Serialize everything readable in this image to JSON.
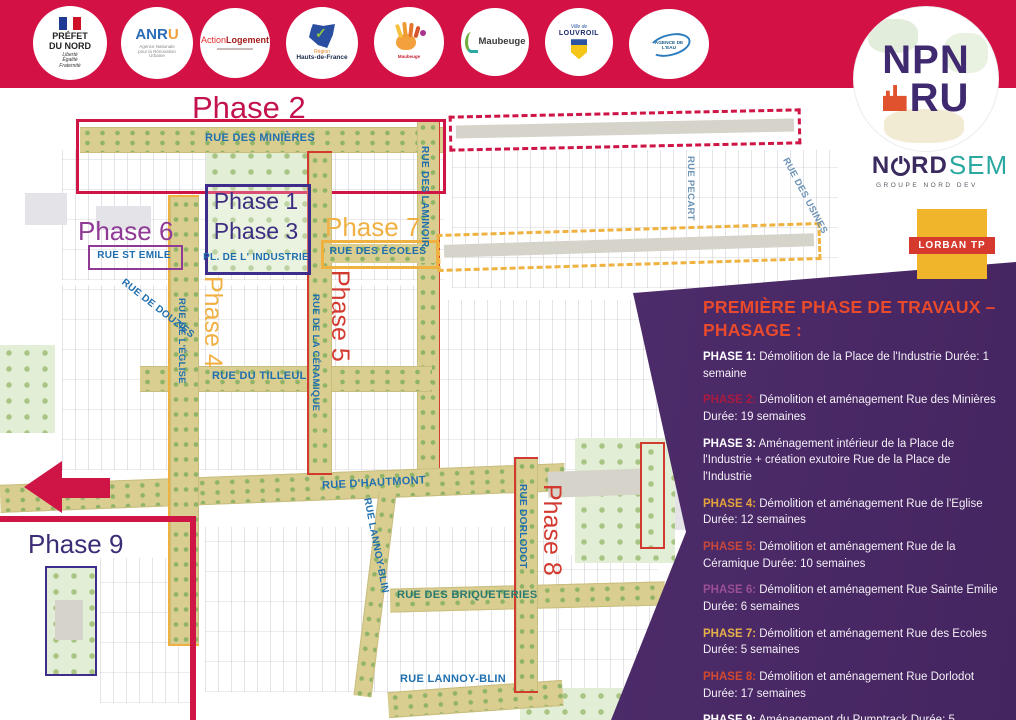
{
  "banner": {
    "logos": {
      "prefet": {
        "t1": "PRÉFET",
        "t2": "DU NORD",
        "m1": "Liberté",
        "m2": "Égalité",
        "m3": "Fraternité"
      },
      "anru": {
        "t1a": "ANR",
        "t1b": "U",
        "sub": "Agence Nationale pour la Rénovation Urbaine"
      },
      "action_logement": {
        "t1a": "Action",
        "t1b": "Logement"
      },
      "hauts_de_france": {
        "t1": "Région",
        "t2": "Hauts-de-France"
      },
      "maubeuge_creative": {
        "t1": "Maubeuge"
      },
      "maubeuge": {
        "t1": "Maubeuge"
      },
      "louvroil": {
        "t1": "Ville de",
        "t2": "LOUVROIL"
      },
      "agence_eau": {
        "t1": "AGENCE DE L'EAU"
      }
    }
  },
  "brand": {
    "npnru": {
      "top": "NPN",
      "bottom": "RU"
    },
    "nordsem": {
      "n": "N",
      "rd": "RD",
      "sem": "SEM",
      "sub": "GROUPE NORD DEV"
    },
    "lorban": {
      "label": "LORBAN TP"
    }
  },
  "map": {
    "phases": {
      "p1": "Phase 1",
      "p2": "Phase 2",
      "p3": "Phase 3",
      "p4": "Phase 4",
      "p5": "Phase 5",
      "p6": "Phase 6",
      "p7": "Phase 7",
      "p8": "Phase 8",
      "p9": "Phase 9"
    },
    "phase_colors": {
      "p1": "#3c2d82",
      "p2": "#c4134c",
      "p3": "#3c2d82",
      "p4": "#f0b043",
      "p5": "#d23a30",
      "p6": "#8f3b96",
      "p7": "#f0b043",
      "p8": "#d23a30",
      "p9": "#3d2d77"
    },
    "streets": {
      "minieres": "RUE DES MINIÈRES",
      "laminoir": "RUE DES LAMINOIR",
      "pecart": "RUE PECART",
      "usines": "RUE DES USINES",
      "st_emile": "RUE ST EMILE",
      "pl_industrie": "PL. DE L' INDUSTRIE",
      "ecoles": "RUE DES ÉCOLES",
      "eglise": "RUE DE L'ÉGLISE",
      "ceramique": "RUE DE LA CÉRAMIQUE",
      "tilleul": "RUE DU TILLEUL",
      "douzies": "RUE DE DOUZIES",
      "hautmont": "RUE D'HAUTMONT",
      "dorlodot": "RUE DORLODOT",
      "briqueteries": "RUE DES BRIQUETERIES",
      "lannoy_blin_left": "RUE LANNOY-BLIN",
      "lannoy_blin_bottom": "RUE LANNOY-BLIN"
    }
  },
  "panel": {
    "title_line1": "PREMIÈRE PHASE DE TRAVAUX –",
    "title_line2": "PHASAGE :",
    "title_color": "#e84a2b",
    "background_color": "#46265e",
    "items": [
      {
        "label": "PHASE 1:",
        "color": "#ffffff",
        "text": "Démolition de la Place de l'Industrie Durée: 1 semaine"
      },
      {
        "label": "PHASE 2:",
        "color": "#a91b3e",
        "text": "Démolition et aménagement Rue des Minières Durée: 19 semaines"
      },
      {
        "label": "PHASE 3:",
        "color": "#ffffff",
        "text": "Aménagement intérieur de la Place de l'Industrie + création exutoire Rue de la Place de l'Industrie"
      },
      {
        "label": "PHASE 4:",
        "color": "#e2a33b",
        "text": "Démolition et aménagement Rue de l'Eglise Durée: 12 semaines"
      },
      {
        "label": "PHASE 5:",
        "color": "#c8473c",
        "text": "Démolition et aménagement Rue de la Céramique Durée: 10 semaines"
      },
      {
        "label": "PHASE 6:",
        "color": "#9a4f92",
        "text": "Démolition et aménagement Rue Sainte Emilie Durée: 6 semaines"
      },
      {
        "label": "PHASE 7:",
        "color": "#e5b04a",
        "text": "Démolition et aménagement Rue des Ecoles Durée: 5 semaines"
      },
      {
        "label": "PHASE 8:",
        "color": "#d2492f",
        "text": "Démolition et aménagement Rue Dorlodot Durée: 17 semaines"
      },
      {
        "label": "PHASE 9:",
        "color": "#ffffff",
        "text": "Aménagement du Pumptrack Durée: 5 semaines"
      }
    ]
  },
  "colors": {
    "banner": "#d31145",
    "crimson_outline": "#cf1446",
    "street_label_blue": "#1f6fae",
    "street_band_tan": "#d9cd90"
  }
}
